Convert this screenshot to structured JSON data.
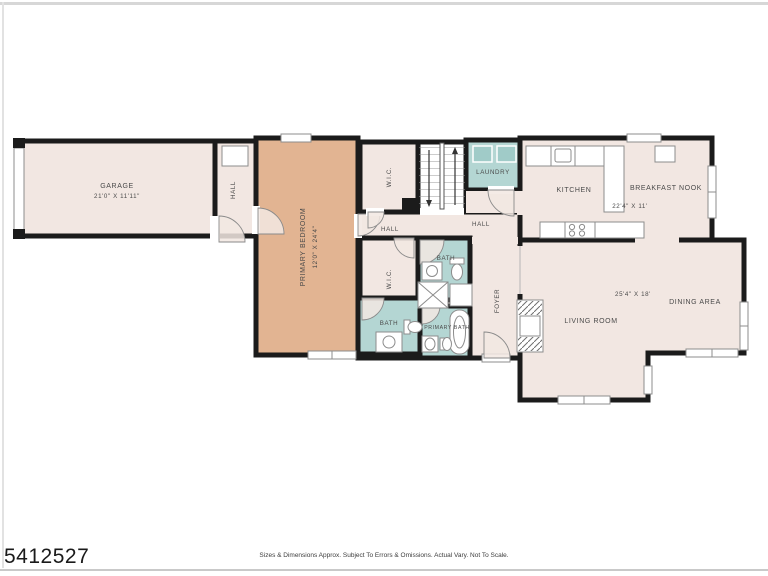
{
  "floor_plan": {
    "rooms": {
      "garage": {
        "label": "GARAGE",
        "dims": "21'0\" X 11'11\""
      },
      "hall_garage": {
        "label": "HALL"
      },
      "primary_bedroom": {
        "label": "PRIMARY BEDROOM",
        "dims": "12'0\" X 24'4\""
      },
      "wic_upper": {
        "label": "W.I.C."
      },
      "laundry": {
        "label": "LAUNDRY"
      },
      "kitchen": {
        "label": "KITCHEN"
      },
      "breakfast_nook": {
        "label": "BREAKFAST NOOK",
        "dims": "22'4\" X 11'"
      },
      "hall_bedroom": {
        "label": "HALL"
      },
      "hall_main": {
        "label": "HALL"
      },
      "wic_lower": {
        "label": "W.I.C."
      },
      "bath_hall": {
        "label": "BATH"
      },
      "bath_lower": {
        "label": "BATH"
      },
      "primary_bath": {
        "label": "PRIMARY BATH"
      },
      "foyer": {
        "label": "FOYER"
      },
      "living_room": {
        "label": "LIVING ROOM",
        "dims": "25'4\" X 18'"
      },
      "dining_area": {
        "label": "DINING AREA"
      }
    },
    "colors": {
      "room": "#f2e7e2",
      "accent": "#e2b492",
      "wet": "#b4d6d3",
      "appliance": "#a0cbc8",
      "wall": "#1b1b1b",
      "label": "#4a4a4a",
      "fixture": "#8c8c8c"
    }
  },
  "footer": {
    "mls_number": "5412527",
    "disclaimer": "Sizes & Dimensions Approx. Subject To Errors & Omissions. Actual Vary. Not To Scale."
  }
}
